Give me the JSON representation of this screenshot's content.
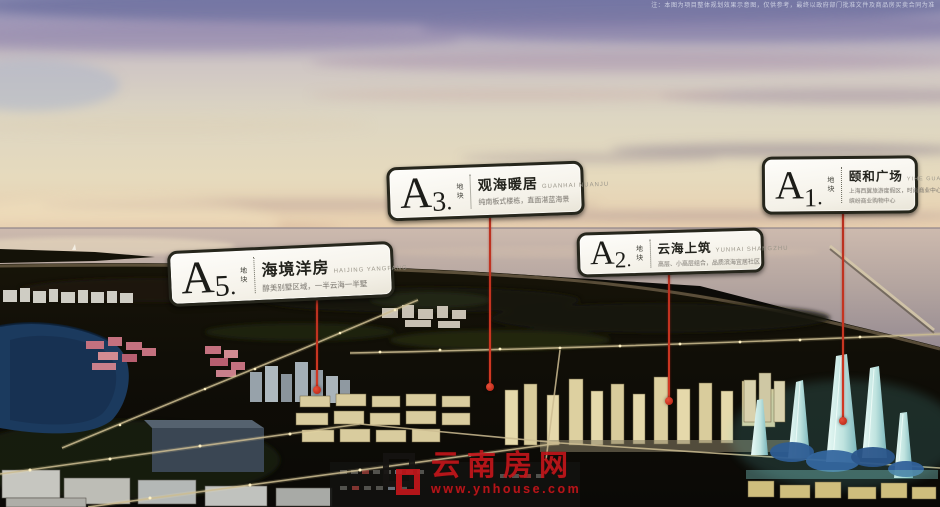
{
  "meta": {
    "disclaimer": "注：本图为项目整体规划效果示意图，仅供参考，最终以政府部门批准文件及商品房买卖合同为准"
  },
  "plots": [
    {
      "letter": "A",
      "number": "5",
      "suffix": ".",
      "unit": "地块",
      "title": "海境洋房",
      "pinyin": "HAIJING YANGFANG",
      "tagline": "醇美别墅区域，一半云海一半墅"
    },
    {
      "letter": "A",
      "number": "3",
      "suffix": ".",
      "unit": "地块",
      "title": "观海暖居",
      "pinyin": "GUANHAI NUANJU",
      "tagline": "纯南板式楼栋，直面湛蓝海景"
    },
    {
      "letter": "A",
      "number": "2",
      "suffix": ".",
      "unit": "地块",
      "title": "云海上筑",
      "pinyin": "YUNHAI SHANGZHU",
      "tagline": "高层、小高层组合，品质滨海宜居社区"
    },
    {
      "letter": "A",
      "number": "1",
      "suffix": ".",
      "unit": "地块",
      "title": "颐和广场",
      "pinyin": "YIHE GUANGCHANG",
      "tagline": "上海西翼旅游度假区，时尚商业中心",
      "tagline2": "缤纷商业购物中心"
    }
  ],
  "watermark": {
    "site_name": "云南房网",
    "site_url": "www.ynhouse.com",
    "brand_red": "#c2161b"
  },
  "colors": {
    "leader_line": "#c43124",
    "label_border": "#26261c",
    "sky_top": "#8a8cb2",
    "sunset": "#e9cfae",
    "sea": "#b3a49f",
    "lake": "#1b3a5e",
    "lit_building": "#e3d7a8",
    "landmark_cyan": "#bfe3df"
  }
}
